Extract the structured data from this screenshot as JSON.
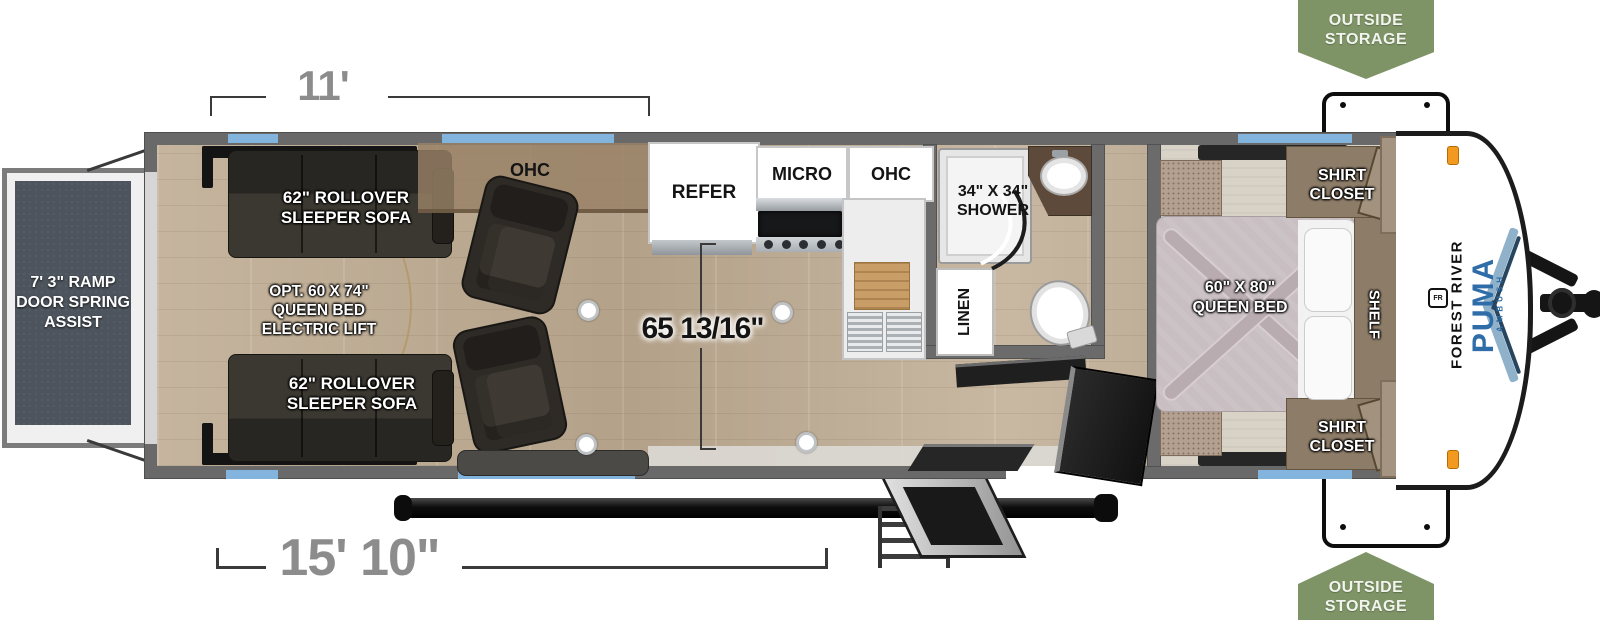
{
  "brand": {
    "manufacturer": "FOREST RIVER",
    "model": "PUMA",
    "trim": "AMBUSH",
    "emblem": "FR"
  },
  "badges": {
    "top_lines": [
      "OUTSIDE",
      "STORAGE"
    ],
    "bottom_lines": [
      "OUTSIDE",
      "STORAGE"
    ]
  },
  "dimensions": {
    "garage_width": "11'",
    "exterior_length": "15' 10\"",
    "interior_width": "65 13/16\"",
    "ramp_lines": [
      "7' 3\"",
      "RAMP DOOR",
      "SPRING",
      "ASSIST"
    ]
  },
  "garage": {
    "sofa_top_lines": [
      "62\" ROLLOVER",
      "SLEEPER SOFA"
    ],
    "sofa_bottom_lines": [
      "62\" ROLLOVER",
      "SLEEPER SOFA"
    ],
    "opt_bed_lines": [
      "OPT. 60 X 74\"",
      "QUEEN BED",
      "ELECTRIC LIFT"
    ],
    "ohc": "OHC"
  },
  "kitchen": {
    "refer": "REFER",
    "micro": "MICRO",
    "ohc": "OHC"
  },
  "bath": {
    "shower_lines": [
      "34\" X 34\"",
      "SHOWER"
    ],
    "linen": "LINEN"
  },
  "bedroom": {
    "bed_lines": [
      "60\" X 80\"",
      "QUEEN BED"
    ],
    "shirt_closet_top_lines": [
      "SHIRT",
      "CLOSET"
    ],
    "shirt_closet_bottom_lines": [
      "SHIRT",
      "CLOSET"
    ],
    "shelf": "SHELF"
  },
  "colors": {
    "window": "#82b4de",
    "badge_green": "#7e9466",
    "dimension_gray": "#8c8c8c",
    "puma_blue": "#2f6da8",
    "wall_gray": "#696969"
  }
}
